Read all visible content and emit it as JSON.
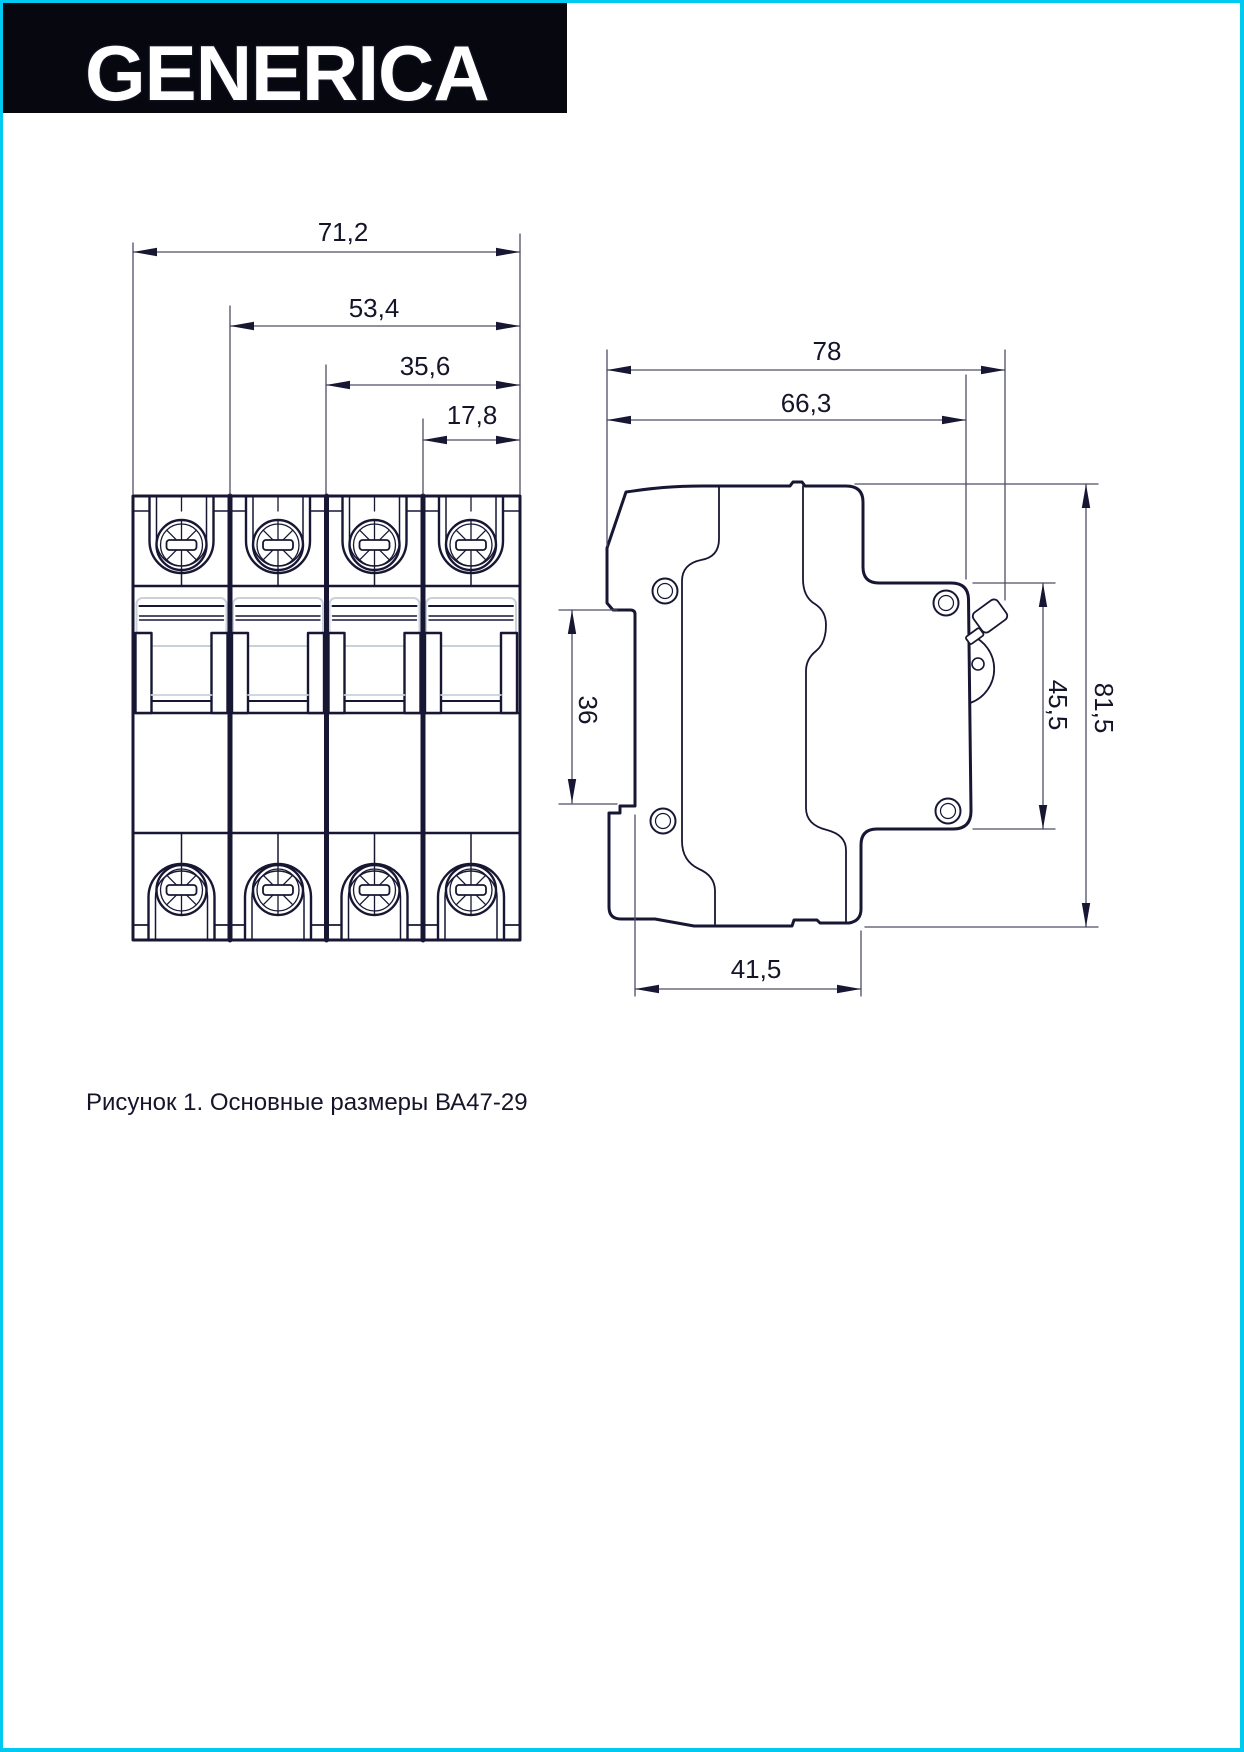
{
  "page": {
    "background": "#ffffff",
    "border_color": "#00c9f2"
  },
  "header": {
    "brand": "GENERICA"
  },
  "dimensions": {
    "front": {
      "total_width": {
        "label": "71,2",
        "mm": 71.2
      },
      "three_pole_width": {
        "label": "53,4",
        "mm": 53.4
      },
      "two_pole_width": {
        "label": "35,6",
        "mm": 35.6
      },
      "one_pole_width": {
        "label": "17,8",
        "mm": 17.8
      }
    },
    "side": {
      "total_depth": {
        "label": "78",
        "mm": 78
      },
      "body_depth": {
        "label": "66,3",
        "mm": 66.3
      },
      "din_recess_height": {
        "label": "36",
        "mm": 36
      },
      "base_depth": {
        "label": "41,5",
        "mm": 41.5
      },
      "front_height": {
        "label": "45,5",
        "mm": 45.5
      },
      "total_height": {
        "label": "81,5",
        "mm": 81.5
      }
    }
  },
  "caption": "Рисунок 1. Основные размеры ВА47-29"
}
